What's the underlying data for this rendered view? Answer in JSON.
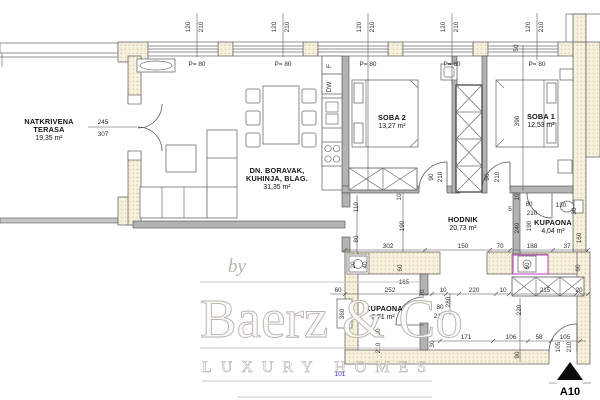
{
  "plan_code": "A10",
  "window_parapet_label": "P= 80",
  "rooms": [
    {
      "id": "terasa",
      "lines": [
        "NATKRIVENA",
        "TERASA"
      ],
      "area": "19,35 m²"
    },
    {
      "id": "living",
      "lines": [
        "DN. BORAVAK,",
        "KUHINJA, BLAG."
      ],
      "area": "31,35 m²"
    },
    {
      "id": "soba2",
      "lines": [
        "SOBA 2"
      ],
      "area": "13,27 m²"
    },
    {
      "id": "soba1",
      "lines": [
        "SOBA 1"
      ],
      "area": "12,53 m²"
    },
    {
      "id": "hodnik",
      "lines": [
        "HODNIK"
      ],
      "area": "20,73 m²"
    },
    {
      "id": "kupaona",
      "lines": [
        "KUPAONA"
      ],
      "area": "4,04 m²"
    },
    {
      "id": "kupaona2",
      "lines": [
        "KUPAONA"
      ],
      "area": "6,71 m²"
    }
  ],
  "watermark": {
    "by": "by",
    "brand": "Baerz & Co",
    "tagline": "LUXURY HOMES"
  },
  "annotations": {
    "blue_note": "101"
  },
  "colors": {
    "highlight_magenta": "#c24ec2",
    "note_blue": "#2b2bc4",
    "wall_hatch": "#f6f0df",
    "hatch_dot": "#dcc187"
  },
  "dimensions": [
    {
      "t": "120",
      "x": 190,
      "y": 27,
      "r": 1
    },
    {
      "t": "210",
      "x": 203,
      "y": 27,
      "r": 1
    },
    {
      "t": "120",
      "x": 276,
      "y": 27,
      "r": 1
    },
    {
      "t": "210",
      "x": 289,
      "y": 27,
      "r": 1
    },
    {
      "t": "120",
      "x": 361,
      "y": 27,
      "r": 1
    },
    {
      "t": "210",
      "x": 374,
      "y": 27,
      "r": 1
    },
    {
      "t": "120",
      "x": 445,
      "y": 27,
      "r": 1
    },
    {
      "t": "210",
      "x": 458,
      "y": 27,
      "r": 1
    },
    {
      "t": "120",
      "x": 530,
      "y": 27,
      "r": 1
    },
    {
      "t": "210",
      "x": 543,
      "y": 27,
      "r": 1
    },
    {
      "t": "P= 80",
      "x": 197,
      "y": 66
    },
    {
      "t": "P= 80",
      "x": 283,
      "y": 66
    },
    {
      "t": "P= 80",
      "x": 368,
      "y": 66
    },
    {
      "t": "P= 80",
      "x": 452,
      "y": 66
    },
    {
      "t": "P= 80",
      "x": 537,
      "y": 66
    },
    {
      "t": "50",
      "x": 518,
      "y": 48,
      "r": 1
    },
    {
      "t": "245",
      "x": 103,
      "y": 124
    },
    {
      "t": "307",
      "x": 103,
      "y": 136
    },
    {
      "t": "F",
      "x": 331,
      "y": 66,
      "r": 1
    },
    {
      "t": "DW",
      "x": 331,
      "y": 87,
      "r": 1
    },
    {
      "t": "390",
      "x": 519,
      "y": 121,
      "r": 1
    },
    {
      "t": "90",
      "x": 433,
      "y": 177,
      "r": 1
    },
    {
      "t": "210",
      "x": 442,
      "y": 177,
      "r": 1
    },
    {
      "t": "90",
      "x": 489,
      "y": 177,
      "r": 1
    },
    {
      "t": "210",
      "x": 499,
      "y": 177,
      "r": 1
    },
    {
      "t": "10",
      "x": 519,
      "y": 197,
      "r": 1
    },
    {
      "t": "80",
      "x": 529,
      "y": 206
    },
    {
      "t": "210",
      "x": 532,
      "y": 215
    },
    {
      "t": "5",
      "x": 510,
      "y": 211
    },
    {
      "t": "130",
      "x": 561,
      "y": 207
    },
    {
      "t": "30",
      "x": 576,
      "y": 211,
      "r": 1
    },
    {
      "t": "240",
      "x": 519,
      "y": 228,
      "r": 1
    },
    {
      "t": "190",
      "x": 531,
      "y": 226,
      "r": 1
    },
    {
      "t": "160",
      "x": 581,
      "y": 238,
      "r": 1
    },
    {
      "t": "10",
      "x": 401,
      "y": 197,
      "r": 1
    },
    {
      "t": "110",
      "x": 358,
      "y": 207,
      "r": 1
    },
    {
      "t": "80",
      "x": 358,
      "y": 239,
      "r": 1
    },
    {
      "t": "190",
      "x": 404,
      "y": 226,
      "r": 1
    },
    {
      "t": "302",
      "x": 388,
      "y": 248
    },
    {
      "t": "150",
      "x": 463,
      "y": 248
    },
    {
      "t": "70",
      "x": 500,
      "y": 248
    },
    {
      "t": "188",
      "x": 532,
      "y": 248
    },
    {
      "t": "37",
      "x": 567,
      "y": 248
    },
    {
      "t": "20",
      "x": 355,
      "y": 265,
      "r": 1
    },
    {
      "t": "40",
      "x": 367,
      "y": 265,
      "r": 1
    },
    {
      "t": "60",
      "x": 402,
      "y": 268,
      "r": 1
    },
    {
      "t": "60",
      "x": 580,
      "y": 268,
      "r": 1
    },
    {
      "t": "60",
      "x": 529,
      "y": 266,
      "r": 1
    },
    {
      "t": "165",
      "x": 404,
      "y": 284
    },
    {
      "t": "60",
      "x": 338,
      "y": 292
    },
    {
      "t": "252",
      "x": 390,
      "y": 292
    },
    {
      "t": "70",
      "x": 424,
      "y": 293,
      "r": 1
    },
    {
      "t": "10",
      "x": 443,
      "y": 292
    },
    {
      "t": "220",
      "x": 474,
      "y": 292
    },
    {
      "t": "10",
      "x": 503,
      "y": 292
    },
    {
      "t": "215",
      "x": 545,
      "y": 292
    },
    {
      "t": "20",
      "x": 579,
      "y": 292
    },
    {
      "t": "280",
      "x": 450,
      "y": 302,
      "r": 1
    },
    {
      "t": "220",
      "x": 521,
      "y": 310,
      "r": 1
    },
    {
      "t": "80",
      "x": 440,
      "y": 309
    },
    {
      "t": "210",
      "x": 439,
      "y": 318
    },
    {
      "t": "80",
      "x": 380,
      "y": 332,
      "r": 1
    },
    {
      "t": "210",
      "x": 380,
      "y": 348,
      "r": 1
    },
    {
      "t": "360",
      "x": 344,
      "y": 314,
      "r": 1
    },
    {
      "t": "30",
      "x": 434,
      "y": 344,
      "r": 1
    },
    {
      "t": "90",
      "x": 519,
      "y": 355,
      "r": 1
    },
    {
      "t": "171",
      "x": 466,
      "y": 339
    },
    {
      "t": "106",
      "x": 511,
      "y": 339
    },
    {
      "t": "58",
      "x": 539,
      "y": 339
    },
    {
      "t": "105",
      "x": 565,
      "y": 339
    },
    {
      "t": "105",
      "x": 560,
      "y": 347,
      "r": 1
    },
    {
      "t": "210",
      "x": 571,
      "y": 347,
      "r": 1
    }
  ]
}
